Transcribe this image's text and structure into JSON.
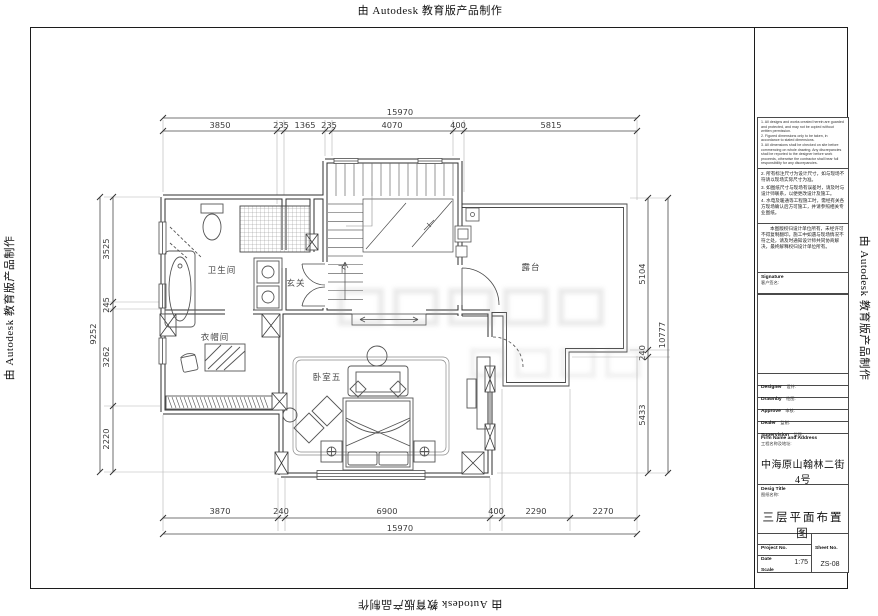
{
  "stamp": "由 Autodesk 教育版产品制作",
  "rooms": {
    "bathroom": "卫生间",
    "foyer": "玄关",
    "cloakroom": "衣帽间",
    "bedroom": "卧室五",
    "terrace": "露台",
    "down": "下"
  },
  "dims": {
    "top_total": "15970",
    "bottom_total": "15970",
    "left_total": "9252",
    "right_total": "10777",
    "top": [
      "3850",
      "235",
      "1365",
      "235",
      "4070",
      "400",
      "5815"
    ],
    "bottom": [
      "3870",
      "240",
      "6900",
      "400",
      "2290",
      "2270"
    ],
    "left": [
      "3525",
      "245",
      "3262",
      "2220"
    ],
    "right": [
      "5104",
      "240",
      "5433"
    ]
  },
  "tb": {
    "notes1": "1. All designs and works created herein are guarded and protected, and may not be copied without written permission.\n2. Figured dimensions only to be taken, in accordance to stated dimensions.\n3. All dimensions shall be checked on site before commencing on whole drawing. Any discrepancies shall be reported to the designer before work proceeds, otherwise the contractor shall bear full responsibility for any discrepancies.",
    "notes2": [
      "2. 所有标注尺寸为设计尺寸，如与现场不符请以现场实际尺寸为准。",
      "3. 如图纸尺寸与现场有误差时，请及时与设计师联系，以便更改设计及施工。",
      "4. 水电及暖通等工程施工时，需经有关各方现场确认后方可施工，并请参照相关专业图纸。"
    ],
    "para": "本图版权归设计单位所有，未经许可不得复制翻印。施工中如遇与现场情况不符之处，请及时通知设计师共同协商解决，最终解释权归设计单位所有。",
    "signature_en": "Signature",
    "signature_cn": "客户签名:",
    "fields": [
      {
        "en": "Designer",
        "cn": "设计:"
      },
      {
        "en": "Drawnby",
        "cn": "绘图:"
      },
      {
        "en": "Approve",
        "cn": "审核:"
      },
      {
        "en": "Dealer",
        "cn": "监制:"
      },
      {
        "en": "Supervision",
        "cn": "监理:"
      }
    ],
    "firm_en": "Firm Name and Address",
    "firm_cn": "工程名称及地址:",
    "firm_value": "中海原山翰林二街4号",
    "title_en": "Desig Title",
    "title_cn": "图纸名称:",
    "title_value": "三层平面布置图",
    "project_label": "Project No.",
    "date_label": "Date",
    "scale_label": "Scale",
    "scale_value": "1:75",
    "sheet_label": "Sheet No.",
    "sheet_value": "ZS-08"
  }
}
